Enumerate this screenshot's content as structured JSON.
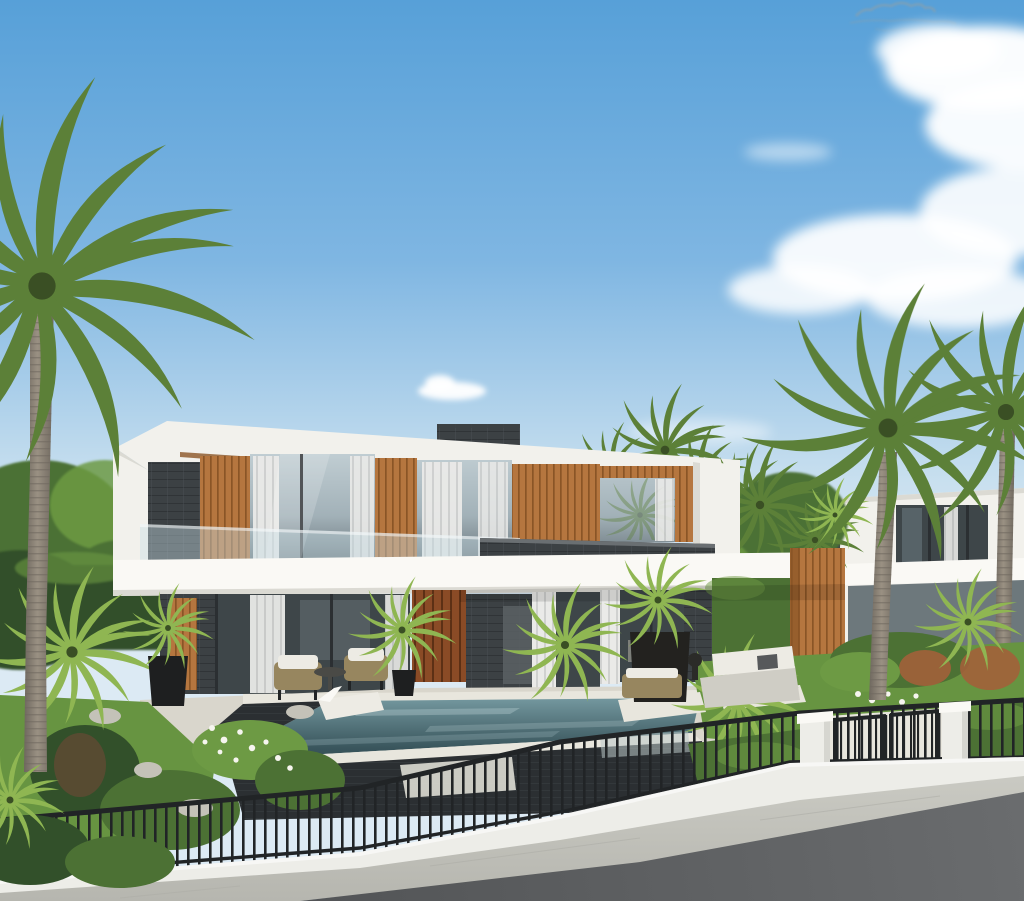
{
  "meta": {
    "description": "Photorealistic architectural rendering of a modern two-story villa with flat white roof bands, wood-slat panels, dark stone walls and glass facades; swimming pool with in-water loungers in front, tropical garden with palm trees, a black metal picket fence with white pillars and gate, white boundary wall, paved sidewalk and asphalt road in the foreground, under a blue sky with scattered clouds; small illegible watermark scribble at top right.",
    "width": "1024",
    "height": "901"
  },
  "scene": {
    "elements": [
      "sky",
      "cloud",
      "watermark-scribble",
      "background-trees",
      "neighbor-house",
      "background-palm",
      "main-villa",
      "roof-fascia",
      "wood-slat-panel",
      "glass-window",
      "curtain",
      "glass-balustrade",
      "stone-parapet",
      "canopy-slab",
      "wood-entrance-door",
      "wood-fin-wall",
      "patio-sofa",
      "wicker-chair",
      "planter-pot",
      "swimming-pool",
      "pool-lounger",
      "garden-bed",
      "lawn",
      "palm-tree",
      "metal-fence",
      "fence-pillar",
      "gate",
      "boundary-wall",
      "sidewalk",
      "road"
    ]
  },
  "colors": {
    "sky-top": "#57A0D8",
    "sky-mid": "#7FB6E2",
    "sky-low": "#C9E0EF",
    "sky-horizon": "#DCEAF4",
    "cloud": "#FFFFFF",
    "white-wall": "#F2F1EC",
    "white-bright": "#FAF9F5",
    "white-shade": "#DBDAD3",
    "stone": "#3C4144",
    "stone-light": "#50575A",
    "stone-dark": "#2B2F32",
    "wood": "#B5763F",
    "wood-dark": "#8A5526",
    "door": "#8A4B26",
    "door-dark": "#5C3015",
    "glass": "#A2B1B8",
    "glass-light": "#C2CfD4",
    "glass-dark": "#5E6A70",
    "interior": "#3E4649",
    "curtain": "#EAEAE8",
    "curtain-shade": "#D0D1D0",
    "balustrade": "#C9DDE4",
    "foliage": "#4C7134",
    "foliage-dark": "#32502A",
    "foliage-light": "#6D9A44",
    "palm": "#5C8038",
    "palm-dark": "#3A4F24",
    "palm-bright": "#8FB652",
    "trunk": "#9A9183",
    "trunk-dark": "#6E675E",
    "grass": "#679441",
    "grass-dark": "#4C7430",
    "deck": "#D9D6CC",
    "deck-light": "#E8E6DD",
    "water": "#39555C",
    "water-light": "#74989F",
    "water-deep": "#243A40",
    "pool-wall": "#4648443",
    "rattan": "#97865F",
    "cushion": "#EDEBE4",
    "fence": "#212426",
    "wall": "#EDEDE8",
    "wall-shade": "#D6D6D0",
    "sidewalk": "#C9C9C2",
    "sidewalk-dark": "#B6B6AF",
    "road": "#6A6C6E",
    "road-dark": "#525456",
    "rock": "#C4C2B8",
    "flower": "#F6F5EF",
    "rust": "#A2613A",
    "watermark": "#8AA0AC"
  }
}
